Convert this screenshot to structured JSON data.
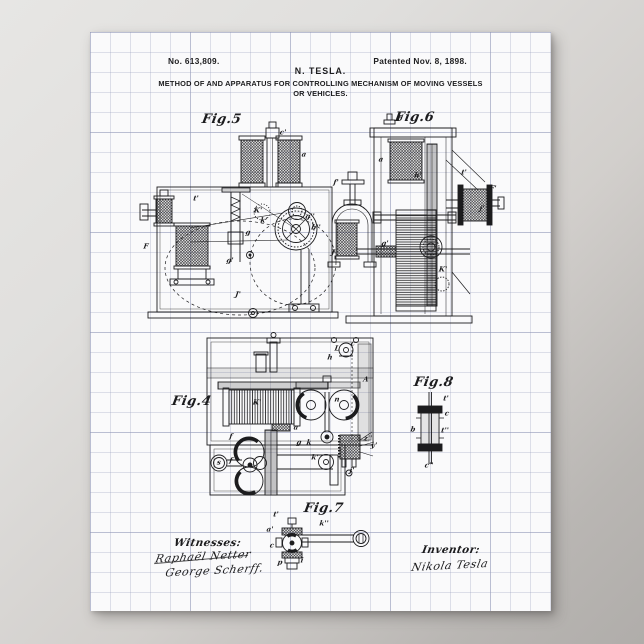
{
  "poster": {
    "background_top": "#e7e6e4",
    "background_bottom": "#b0adaa",
    "paper_color": "#fafafb",
    "grid_color": "#969cbc",
    "ink_color": "#1c1c1e"
  },
  "header": {
    "patent_number": "No. 613,809.",
    "inventor_name": "N. TESLA.",
    "patent_date": "Patented Nov. 8, 1898.",
    "title_line1": "METHOD OF AND APPARATUS FOR CONTROLLING MECHANISM OF MOVING VESSELS",
    "title_line2": "OR VEHICLES."
  },
  "figures": [
    {
      "id": "fig5",
      "label": "Fig.5",
      "annotations": [
        {
          "t": "c'",
          "x": 193,
          "y": 100
        },
        {
          "t": "a",
          "x": 214,
          "y": 122
        },
        {
          "t": "K'",
          "x": 168,
          "y": 178
        },
        {
          "t": "k'",
          "x": 174,
          "y": 188
        },
        {
          "t": "g",
          "x": 158,
          "y": 200
        },
        {
          "t": "g''",
          "x": 220,
          "y": 184
        },
        {
          "t": "b''",
          "x": 226,
          "y": 195
        },
        {
          "t": "F",
          "x": 56,
          "y": 214
        },
        {
          "t": "g'",
          "x": 140,
          "y": 228
        },
        {
          "t": "J'",
          "x": 148,
          "y": 262
        },
        {
          "t": "t'",
          "x": 106,
          "y": 166
        }
      ]
    },
    {
      "id": "fig6",
      "label": "Fig.6",
      "annotations": [
        {
          "t": "b",
          "x": 310,
          "y": 86
        },
        {
          "t": "a",
          "x": 291,
          "y": 127
        },
        {
          "t": "f'",
          "x": 246,
          "y": 150
        },
        {
          "t": "h'",
          "x": 328,
          "y": 143
        },
        {
          "t": "t'",
          "x": 374,
          "y": 140
        },
        {
          "t": "F'",
          "x": 403,
          "y": 156
        },
        {
          "t": "j'",
          "x": 392,
          "y": 176
        },
        {
          "t": "K'",
          "x": 353,
          "y": 237
        },
        {
          "t": "J",
          "x": 243,
          "y": 220
        },
        {
          "t": "g'",
          "x": 295,
          "y": 211
        }
      ]
    },
    {
      "id": "fig4",
      "label": "Fig.4",
      "annotations": [
        {
          "t": "c",
          "x": 263,
          "y": 311
        },
        {
          "t": "L",
          "x": 247,
          "y": 316
        },
        {
          "t": "h",
          "x": 240,
          "y": 325
        },
        {
          "t": "K'",
          "x": 167,
          "y": 370
        },
        {
          "t": "a",
          "x": 206,
          "y": 395
        },
        {
          "t": "A",
          "x": 276,
          "y": 347
        },
        {
          "t": "n",
          "x": 247,
          "y": 367
        },
        {
          "t": "g",
          "x": 209,
          "y": 410
        },
        {
          "t": "k",
          "x": 219,
          "y": 410
        },
        {
          "t": "k'",
          "x": 225,
          "y": 425
        },
        {
          "t": "f",
          "x": 141,
          "y": 404
        },
        {
          "t": "f",
          "x": 141,
          "y": 428
        },
        {
          "t": "s",
          "x": 129,
          "y": 430
        },
        {
          "t": "j'",
          "x": 262,
          "y": 438
        },
        {
          "t": "z''",
          "x": 278,
          "y": 406
        },
        {
          "t": "y'",
          "x": 284,
          "y": 413
        }
      ]
    },
    {
      "id": "fig8",
      "label": "Fig.8",
      "annotations": [
        {
          "t": "t'",
          "x": 356,
          "y": 366
        },
        {
          "t": "c",
          "x": 357,
          "y": 381
        },
        {
          "t": "b",
          "x": 323,
          "y": 397
        },
        {
          "t": "t''",
          "x": 355,
          "y": 398
        },
        {
          "t": "c''",
          "x": 339,
          "y": 433
        }
      ]
    },
    {
      "id": "fig7",
      "label": "Fig.7",
      "annotations": [
        {
          "t": "t'",
          "x": 186,
          "y": 482
        },
        {
          "t": "a'",
          "x": 180,
          "y": 497
        },
        {
          "t": "c",
          "x": 182,
          "y": 513
        },
        {
          "t": "p",
          "x": 190,
          "y": 530
        },
        {
          "t": "i",
          "x": 212,
          "y": 528
        },
        {
          "t": "k''",
          "x": 234,
          "y": 491
        }
      ]
    }
  ],
  "signatures": {
    "witnesses_label": "Witnesses:",
    "witness1": "Raphaël Netter",
    "witness2": "George Scherff.",
    "inventor_label": "Inventor:",
    "inventor_signature": "Nikola Tesla"
  }
}
